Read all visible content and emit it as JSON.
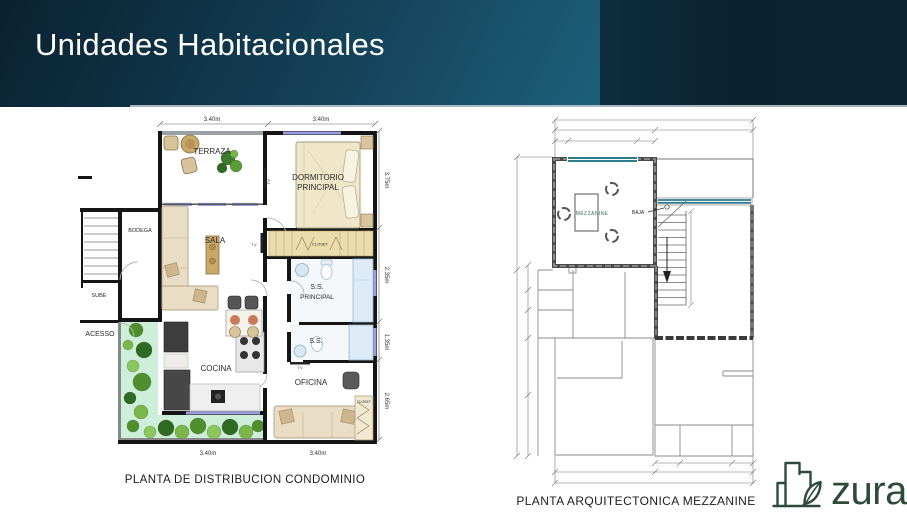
{
  "slide": {
    "title": "Unidades Habitacionales"
  },
  "left_plan": {
    "caption": "PLANTA DE DISTRIBUCION CONDOMINIO",
    "labels": {
      "terraza": "TERRAZA",
      "dormitorio1": "DORMITORIO",
      "dormitorio2": "PRINCIPAL",
      "bodega": "BODEGA",
      "sube": "SUBE",
      "sala": "SALA",
      "closet_top": "CLOSET",
      "ss_principal1": "S.S.",
      "ss_principal2": "PRINCIPAL",
      "ss": "S.S.",
      "acesso": "ACESSO",
      "cocina": "COCINA",
      "oficina": "OFICINA",
      "closet_right": "CLOSET",
      "tv_a": "T.V",
      "tv_b": "T.V",
      "tv_c": "T.V"
    },
    "dimensions": {
      "top_left": "3.40m",
      "top_right": "3.40m",
      "bottom_left": "3.40m",
      "bottom_right": "3.40m",
      "right_dormitorio": "3.75m",
      "right_ss_principal": "2.35m",
      "right_ss": "1.35m",
      "right_oficina": "2.65m"
    }
  },
  "right_plan": {
    "caption": "PLANTA ARQUITECTONICA MEZZANINE",
    "labels": {
      "mezzanine": "MEZZANINE",
      "baja": "BAJA"
    }
  },
  "logo": {
    "name": "zura"
  },
  "colors": {
    "banner_teal": "#1d5f7a",
    "banner_dark": "#0b2231",
    "window_accent": "#9a9ede",
    "mezzanine_window": "#2e7d8c",
    "garden": "#cdefd9",
    "logo_green": "#2d4a3a"
  }
}
